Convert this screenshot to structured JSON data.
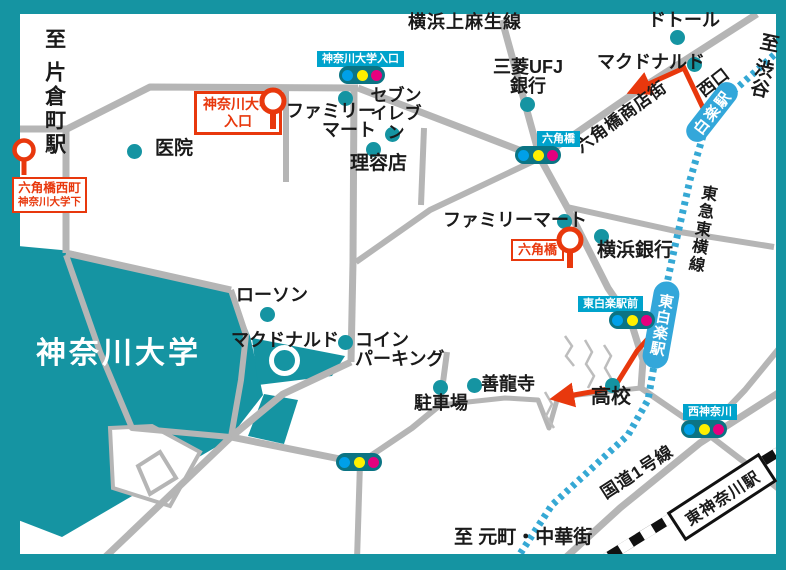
{
  "campus": {
    "name": "神奈川大学"
  },
  "colors": {
    "campus_teal": "#1594A2",
    "label_blue": "#00A3CC",
    "station_blue": "#33A7DA",
    "signal_box": "#0B7484",
    "signal_blue": "#00A0E9",
    "signal_yellow": "#FFF000",
    "signal_magenta": "#E6007E",
    "accent_red": "#E8380D",
    "road_gray": "#B5B5B5",
    "rail_blue": "#35A8D4"
  },
  "directions": {
    "katakuracho": "至 片倉町駅",
    "shibuya": "至 渋谷",
    "motomachi_chukagai": "至 元町・中華街",
    "nishiguchi": "西口"
  },
  "railways": {
    "tokyu_toyoko_line": "東急東横線",
    "hakuraku_station": "白楽駅",
    "higashi_hakuraku_station": "東白楽駅",
    "higashi_kanagawa_station": "東神奈川駅"
  },
  "roads": {
    "yokohama_kamiasao_line": "横浜上麻生線",
    "rokkakubashi_shopping_street": "六角橋商店街",
    "route_1": "国道1号線"
  },
  "bus_stops": {
    "rokkakubashi_nishimachi": {
      "line1": "六角橋西町",
      "line2": "神奈川大学下"
    },
    "kanagawa_univ_entrance": {
      "line1": "神奈川大学",
      "line2": "入口"
    },
    "rokkakubashi": {
      "line1": "六角橋"
    }
  },
  "signals": {
    "kanagawa_univ_entrance": "神奈川大学入口",
    "rokkakubashi": "六角橋",
    "higashi_hakuraku_ekimae": "東白楽駅前",
    "nishi_kanagawa": "西神奈川"
  },
  "pois": {
    "clinic": "医院",
    "family_mart_north": "ファミリー\nマート",
    "seven_eleven": "セブン\nイレブン",
    "barber": "理容店",
    "mufg_bank": "三菱UFJ\n銀行",
    "doutor": "ドトール",
    "mcdonalds_east": "マクドナルド",
    "mcdonalds_west": "マクドナルド",
    "lawson": "ローソン",
    "coin_parking": "コイン\nパーキング",
    "parking_lot": "駐車場",
    "zenryuji_temple": "善龍寺",
    "yokohama_bank": "横浜銀行",
    "family_mart_south": "ファミリーマート",
    "high_school": "高校"
  }
}
